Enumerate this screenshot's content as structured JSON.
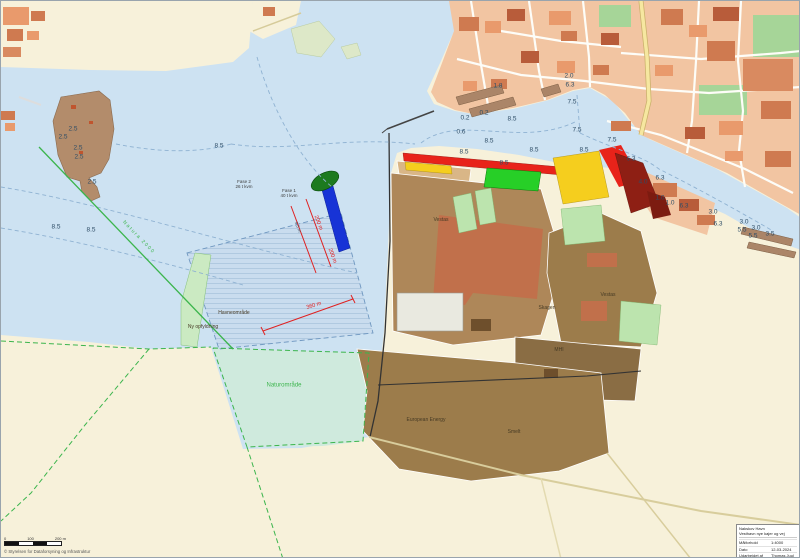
{
  "palette": {
    "land": "#f7f1da",
    "water": "#cde2f2",
    "lagoon": "#cfeadd",
    "island": "#b38c6b",
    "town": "#f2c5a2",
    "park": "#a6d598",
    "street": "#fdfdf8",
    "road_yellow": "#f6e7a0",
    "building_light": "#e99a6c",
    "building_mid": "#cf7a50",
    "building_dark": "#b85c3a",
    "building_industrial": "#d98a60",
    "field_light": "#d9b687",
    "field_mid": "#ae8759",
    "field_deep": "#9c7c4b",
    "field_dark": "#8a6d44",
    "factory": "#c1704b",
    "zone_red": "#e8231a",
    "zone_yellow": "#f5ce1e",
    "zone_green": "#27cf27",
    "zone_darkred": "#8e1f14",
    "quay_blue": "#1733d6",
    "ellipse_green": "#1d7a1f",
    "green_strip": "#cbeac2",
    "basin": "#c9dcee",
    "natura_green": "#3cb54d",
    "dim_red": "#e02020",
    "depth_text": "#2e4d66",
    "pier": "#ab8568"
  },
  "title_block": {
    "org": "Nakskov Havn",
    "project": "Vesthavn nye kajer og vej",
    "rows": [
      {
        "label": "Målforhold",
        "value": "1:4000"
      },
      {
        "label": "Dato",
        "value": "12-03-2024"
      },
      {
        "label": "Udarbejdet af",
        "value": "Thomas Juul"
      }
    ]
  },
  "footer": {
    "copyright": "© Styrelsen for Dataforsyning og Infrastruktur",
    "scale": {
      "l0": "0",
      "l1": "100",
      "l2": "200 m"
    }
  },
  "map": {
    "labels": [
      {
        "t": "2.5",
        "x": 72,
        "y": 128,
        "c": "depth"
      },
      {
        "t": "2.5",
        "x": 62,
        "y": 136,
        "c": "depth"
      },
      {
        "t": "2.5",
        "x": 77,
        "y": 147,
        "c": "depth"
      },
      {
        "t": "2.5",
        "x": 78,
        "y": 156,
        "c": "depth"
      },
      {
        "t": "2.5",
        "x": 91,
        "y": 181,
        "c": "depth"
      },
      {
        "t": "8.5",
        "x": 55,
        "y": 226,
        "c": "depth"
      },
      {
        "t": "8.5",
        "x": 90,
        "y": 229,
        "c": "depth"
      },
      {
        "t": "8.5",
        "x": 218,
        "y": 145,
        "c": "depth"
      },
      {
        "t": "1.8",
        "x": 497,
        "y": 85,
        "c": "depth"
      },
      {
        "t": "2.0",
        "x": 568,
        "y": 75,
        "c": "depth"
      },
      {
        "t": "6.3",
        "x": 569,
        "y": 84,
        "c": "depth"
      },
      {
        "t": "7.5",
        "x": 571,
        "y": 101,
        "c": "depth"
      },
      {
        "t": "0.2",
        "x": 464,
        "y": 117,
        "c": "depth"
      },
      {
        "t": "0.2",
        "x": 483,
        "y": 112,
        "c": "depth"
      },
      {
        "t": "8.5",
        "x": 511,
        "y": 118,
        "c": "depth"
      },
      {
        "t": "0.6",
        "x": 460,
        "y": 131,
        "c": "depth"
      },
      {
        "t": "8.5",
        "x": 488,
        "y": 140,
        "c": "depth"
      },
      {
        "t": "7.5",
        "x": 576,
        "y": 129,
        "c": "depth"
      },
      {
        "t": "7.5",
        "x": 611,
        "y": 139,
        "c": "depth"
      },
      {
        "t": "8.5",
        "x": 463,
        "y": 151,
        "c": "depth"
      },
      {
        "t": "8.5",
        "x": 533,
        "y": 149,
        "c": "depth"
      },
      {
        "t": "8.5",
        "x": 583,
        "y": 149,
        "c": "depth"
      },
      {
        "t": "8.5",
        "x": 503,
        "y": 162,
        "c": "depth"
      },
      {
        "t": "6.3",
        "x": 630,
        "y": 158,
        "c": "depth"
      },
      {
        "t": "6.3",
        "x": 659,
        "y": 177,
        "c": "depth"
      },
      {
        "t": "4.0",
        "x": 642,
        "y": 181,
        "c": "depth"
      },
      {
        "t": "1.0",
        "x": 659,
        "y": 197,
        "c": "depth"
      },
      {
        "t": "1.0",
        "x": 669,
        "y": 202,
        "c": "depth"
      },
      {
        "t": "6.3",
        "x": 683,
        "y": 205,
        "c": "depth"
      },
      {
        "t": "3.0",
        "x": 712,
        "y": 211,
        "c": "depth"
      },
      {
        "t": "6.3",
        "x": 717,
        "y": 223,
        "c": "depth"
      },
      {
        "t": "3.0",
        "x": 743,
        "y": 221,
        "c": "depth"
      },
      {
        "t": "5.5",
        "x": 741,
        "y": 229,
        "c": "depth"
      },
      {
        "t": "3.0",
        "x": 755,
        "y": 227,
        "c": "depth"
      },
      {
        "t": "5.5",
        "x": 752,
        "y": 235,
        "c": "depth"
      },
      {
        "t": "3.5",
        "x": 769,
        "y": 233,
        "c": "depth"
      },
      {
        "t": "Vestas",
        "x": 440,
        "y": 220,
        "c": "place"
      },
      {
        "t": "Vestas",
        "x": 607,
        "y": 295,
        "c": "place"
      },
      {
        "t": "Skagen",
        "x": 546,
        "y": 308,
        "c": "place"
      },
      {
        "t": "MHI",
        "x": 558,
        "y": 350,
        "c": "place"
      },
      {
        "t": "European Energy",
        "x": 425,
        "y": 420,
        "c": "place"
      },
      {
        "t": "Smelt",
        "x": 513,
        "y": 432,
        "c": "place"
      },
      {
        "t": "Havneområde",
        "x": 233,
        "y": 313,
        "c": "place"
      },
      {
        "t": "Ny opfyldning",
        "x": 202,
        "y": 327,
        "c": "place"
      },
      {
        "t": "Naturområde",
        "x": 283,
        "y": 385,
        "c": "natureLbl"
      },
      {
        "t": "Natura 2000",
        "x": 137,
        "y": 237,
        "c": "natureLine",
        "r": 46
      },
      {
        "t": "Fase 2\n26 t kvm",
        "x": 243,
        "y": 183,
        "c": "phase"
      },
      {
        "t": "Fase 1\n40 t kvm",
        "x": 288,
        "y": 192,
        "c": "phase"
      },
      {
        "t": "200 m",
        "x": 317,
        "y": 222,
        "c": "dim",
        "r": 69
      },
      {
        "t": "200 m",
        "x": 331,
        "y": 255,
        "c": "dim",
        "r": 69
      },
      {
        "t": "360 m",
        "x": 313,
        "y": 305,
        "c": "dim",
        "r": -17
      },
      {
        "t": "9,5 m",
        "x": 297,
        "y": 226,
        "c": "chan",
        "r": 69
      }
    ]
  }
}
